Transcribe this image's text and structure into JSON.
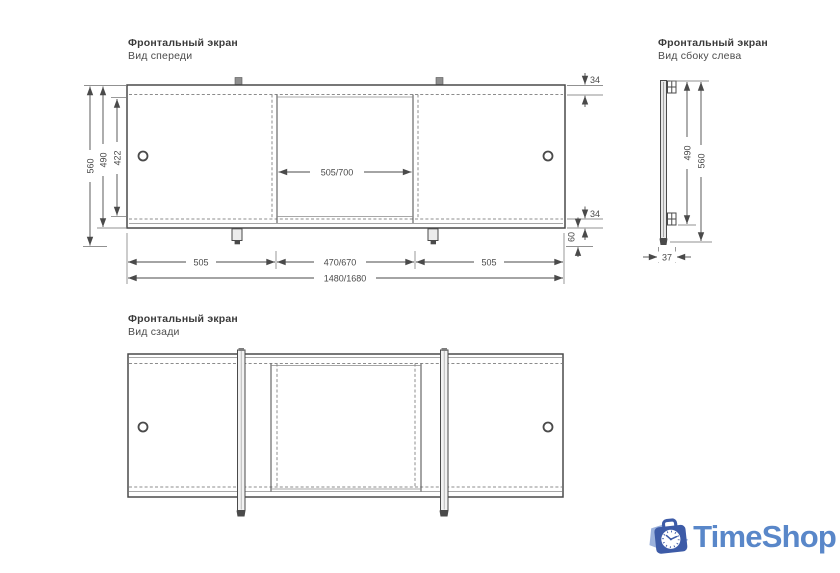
{
  "drawing": {
    "line_color": "#4a4a4a",
    "dash_color": "#8c8c8c",
    "front": {
      "title": "Фронтальный экран",
      "subtitle": "Вид спереди",
      "dims": {
        "total_height": "560",
        "panel_height": "490",
        "opening_height": "422",
        "top_rail": "34",
        "bottom_rail": "34",
        "leg_height": "60",
        "middle_panel": "505/700",
        "section_left": "505",
        "section_center": "470/670",
        "section_right": "505",
        "total_width": "1480/1680"
      }
    },
    "side": {
      "title": "Фронтальный экран",
      "subtitle": "Вид сбоку слева",
      "dims": {
        "panel_height": "490",
        "total_height": "560",
        "depth": "37"
      }
    },
    "back": {
      "title": "Фронтальный экран",
      "subtitle": "Вид сзади"
    }
  },
  "logo": {
    "text": "TimeShop",
    "text_color": "#5987c9",
    "icon_dark": "#3d5ba7",
    "icon_light": "#9cb2dc"
  }
}
